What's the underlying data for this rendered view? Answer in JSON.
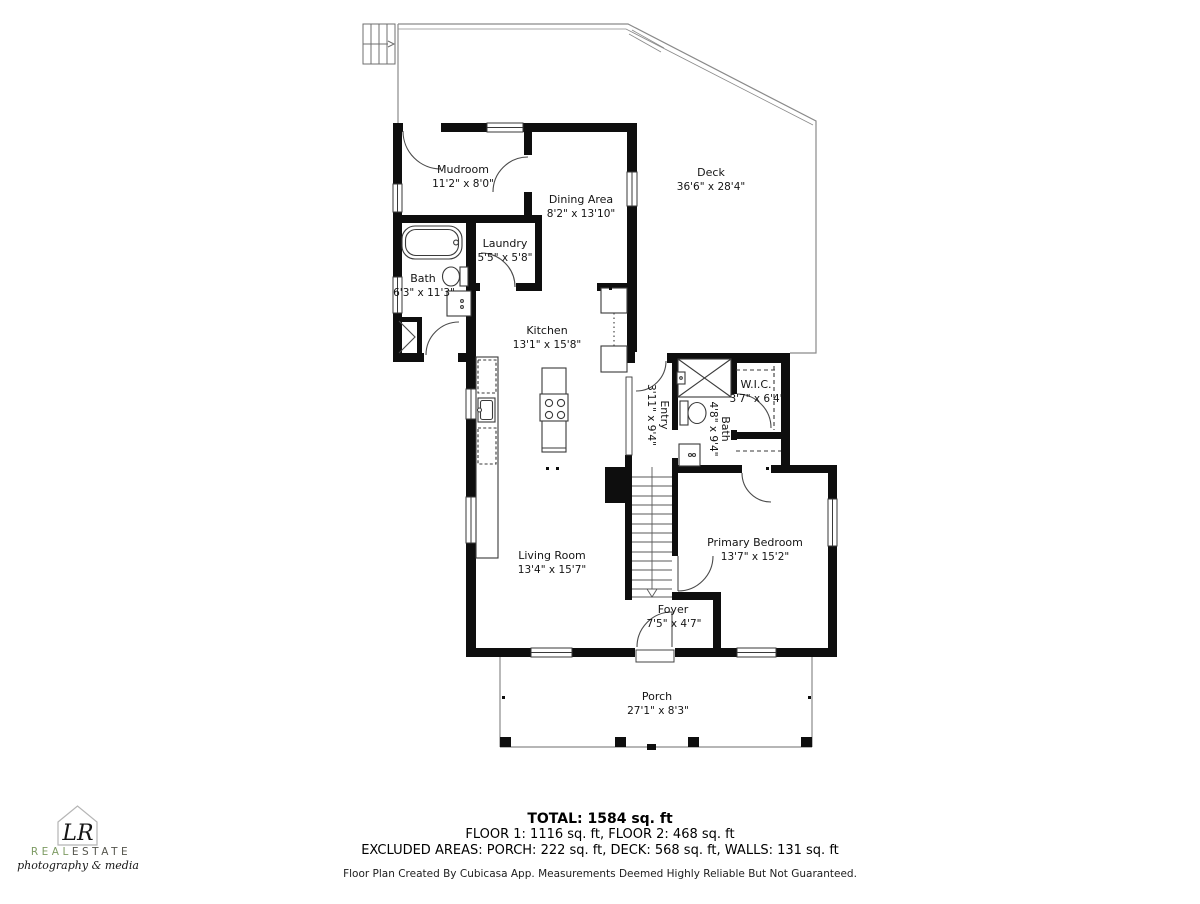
{
  "rooms": [
    {
      "name": "Mudroom",
      "dims": "11'2\" x 8'0\""
    },
    {
      "name": "Dining Area",
      "dims": "8'2\" x 13'10\""
    },
    {
      "name": "Deck",
      "dims": "36'6\" x 28'4\""
    },
    {
      "name": "Laundry",
      "dims": "5'5\" x 5'8\""
    },
    {
      "name": "Bath",
      "dims": "6'3\" x 11'3\""
    },
    {
      "name": "Kitchen",
      "dims": "13'1\" x 15'8\""
    },
    {
      "name": "Entry",
      "dims": "3'11\" x 9'4\""
    },
    {
      "name": "Bath",
      "dims": "4'8\" x 9'4\""
    },
    {
      "name": "W.I.C.",
      "dims": "3'7\" x 6'4\""
    },
    {
      "name": "Living Room",
      "dims": "13'4\" x 15'7\""
    },
    {
      "name": "Primary Bedroom",
      "dims": "13'7\" x 15'2\""
    },
    {
      "name": "Foyer",
      "dims": "7'5\" x 4'7\""
    },
    {
      "name": "Porch",
      "dims": "27'1\" x 8'3\""
    }
  ],
  "summary": {
    "total": "TOTAL: 1584 sq. ft",
    "floors": "FLOOR 1: 1116 sq. ft, FLOOR 2: 468 sq. ft",
    "excluded": "EXCLUDED AREAS: PORCH: 222 sq. ft, DECK: 568 sq. ft, WALLS: 131 sq. ft",
    "disclaimer": "Floor Plan Created By Cubicasa App. Measurements Deemed Highly Reliable But Not Guaranteed."
  },
  "logo": {
    "monogram": "LR",
    "brand_real": "REAL",
    "brand_estate": "ESTATE",
    "tagline": "photography & media",
    "green": "#7d9b63",
    "dark": "#55554d"
  },
  "colors": {
    "wall": "#0e0e0e",
    "thin_line": "#8a8a8a",
    "fixture": "#3a3a3a"
  }
}
